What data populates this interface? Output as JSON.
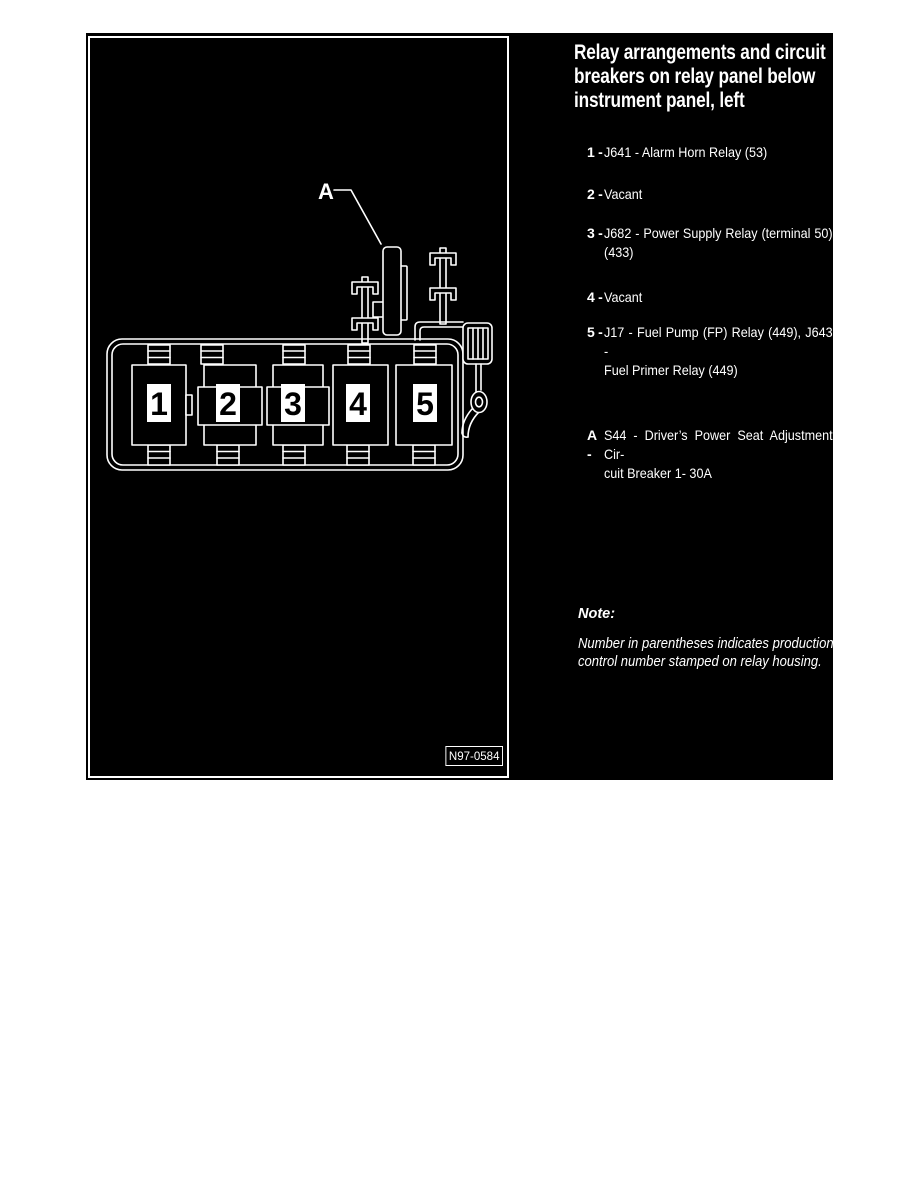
{
  "colors": {
    "page_background": "#ffffff",
    "panel_background": "#000000",
    "foreground": "#ffffff"
  },
  "figure": {
    "marker_label": "A",
    "relay_numbers": [
      "1",
      "2",
      "3",
      "4",
      "5"
    ],
    "figure_number": "N97-0584"
  },
  "text_panel": {
    "title_lines": [
      "Relay arrangements and circuit",
      "breakers on relay panel below",
      "instrument panel, left"
    ],
    "items": [
      {
        "label": "1 -",
        "lines": [
          "J641 - Alarm Horn Relay (53)"
        ]
      },
      {
        "label": "2 -",
        "lines": [
          "Vacant"
        ]
      },
      {
        "label": "3 -",
        "lines": [
          "J682 - Power Supply Relay (terminal 50)",
          "(433)"
        ]
      },
      {
        "label": "4 -",
        "lines": [
          "Vacant"
        ]
      },
      {
        "label": "5 -",
        "lines": [
          "J17 - Fuel Pump (FP) Relay (449), J643 -",
          "Fuel Primer Relay  (449)"
        ]
      }
    ],
    "breaker_item": {
      "label": "A -",
      "lines": [
        "S44 - Driver’s Power Seat Adjustment Cir-",
        "cuit Breaker 1- 30A"
      ]
    },
    "note": {
      "heading": "Note:",
      "lines": [
        "Number in parentheses indicates production",
        "control number stamped on relay housing."
      ]
    }
  }
}
